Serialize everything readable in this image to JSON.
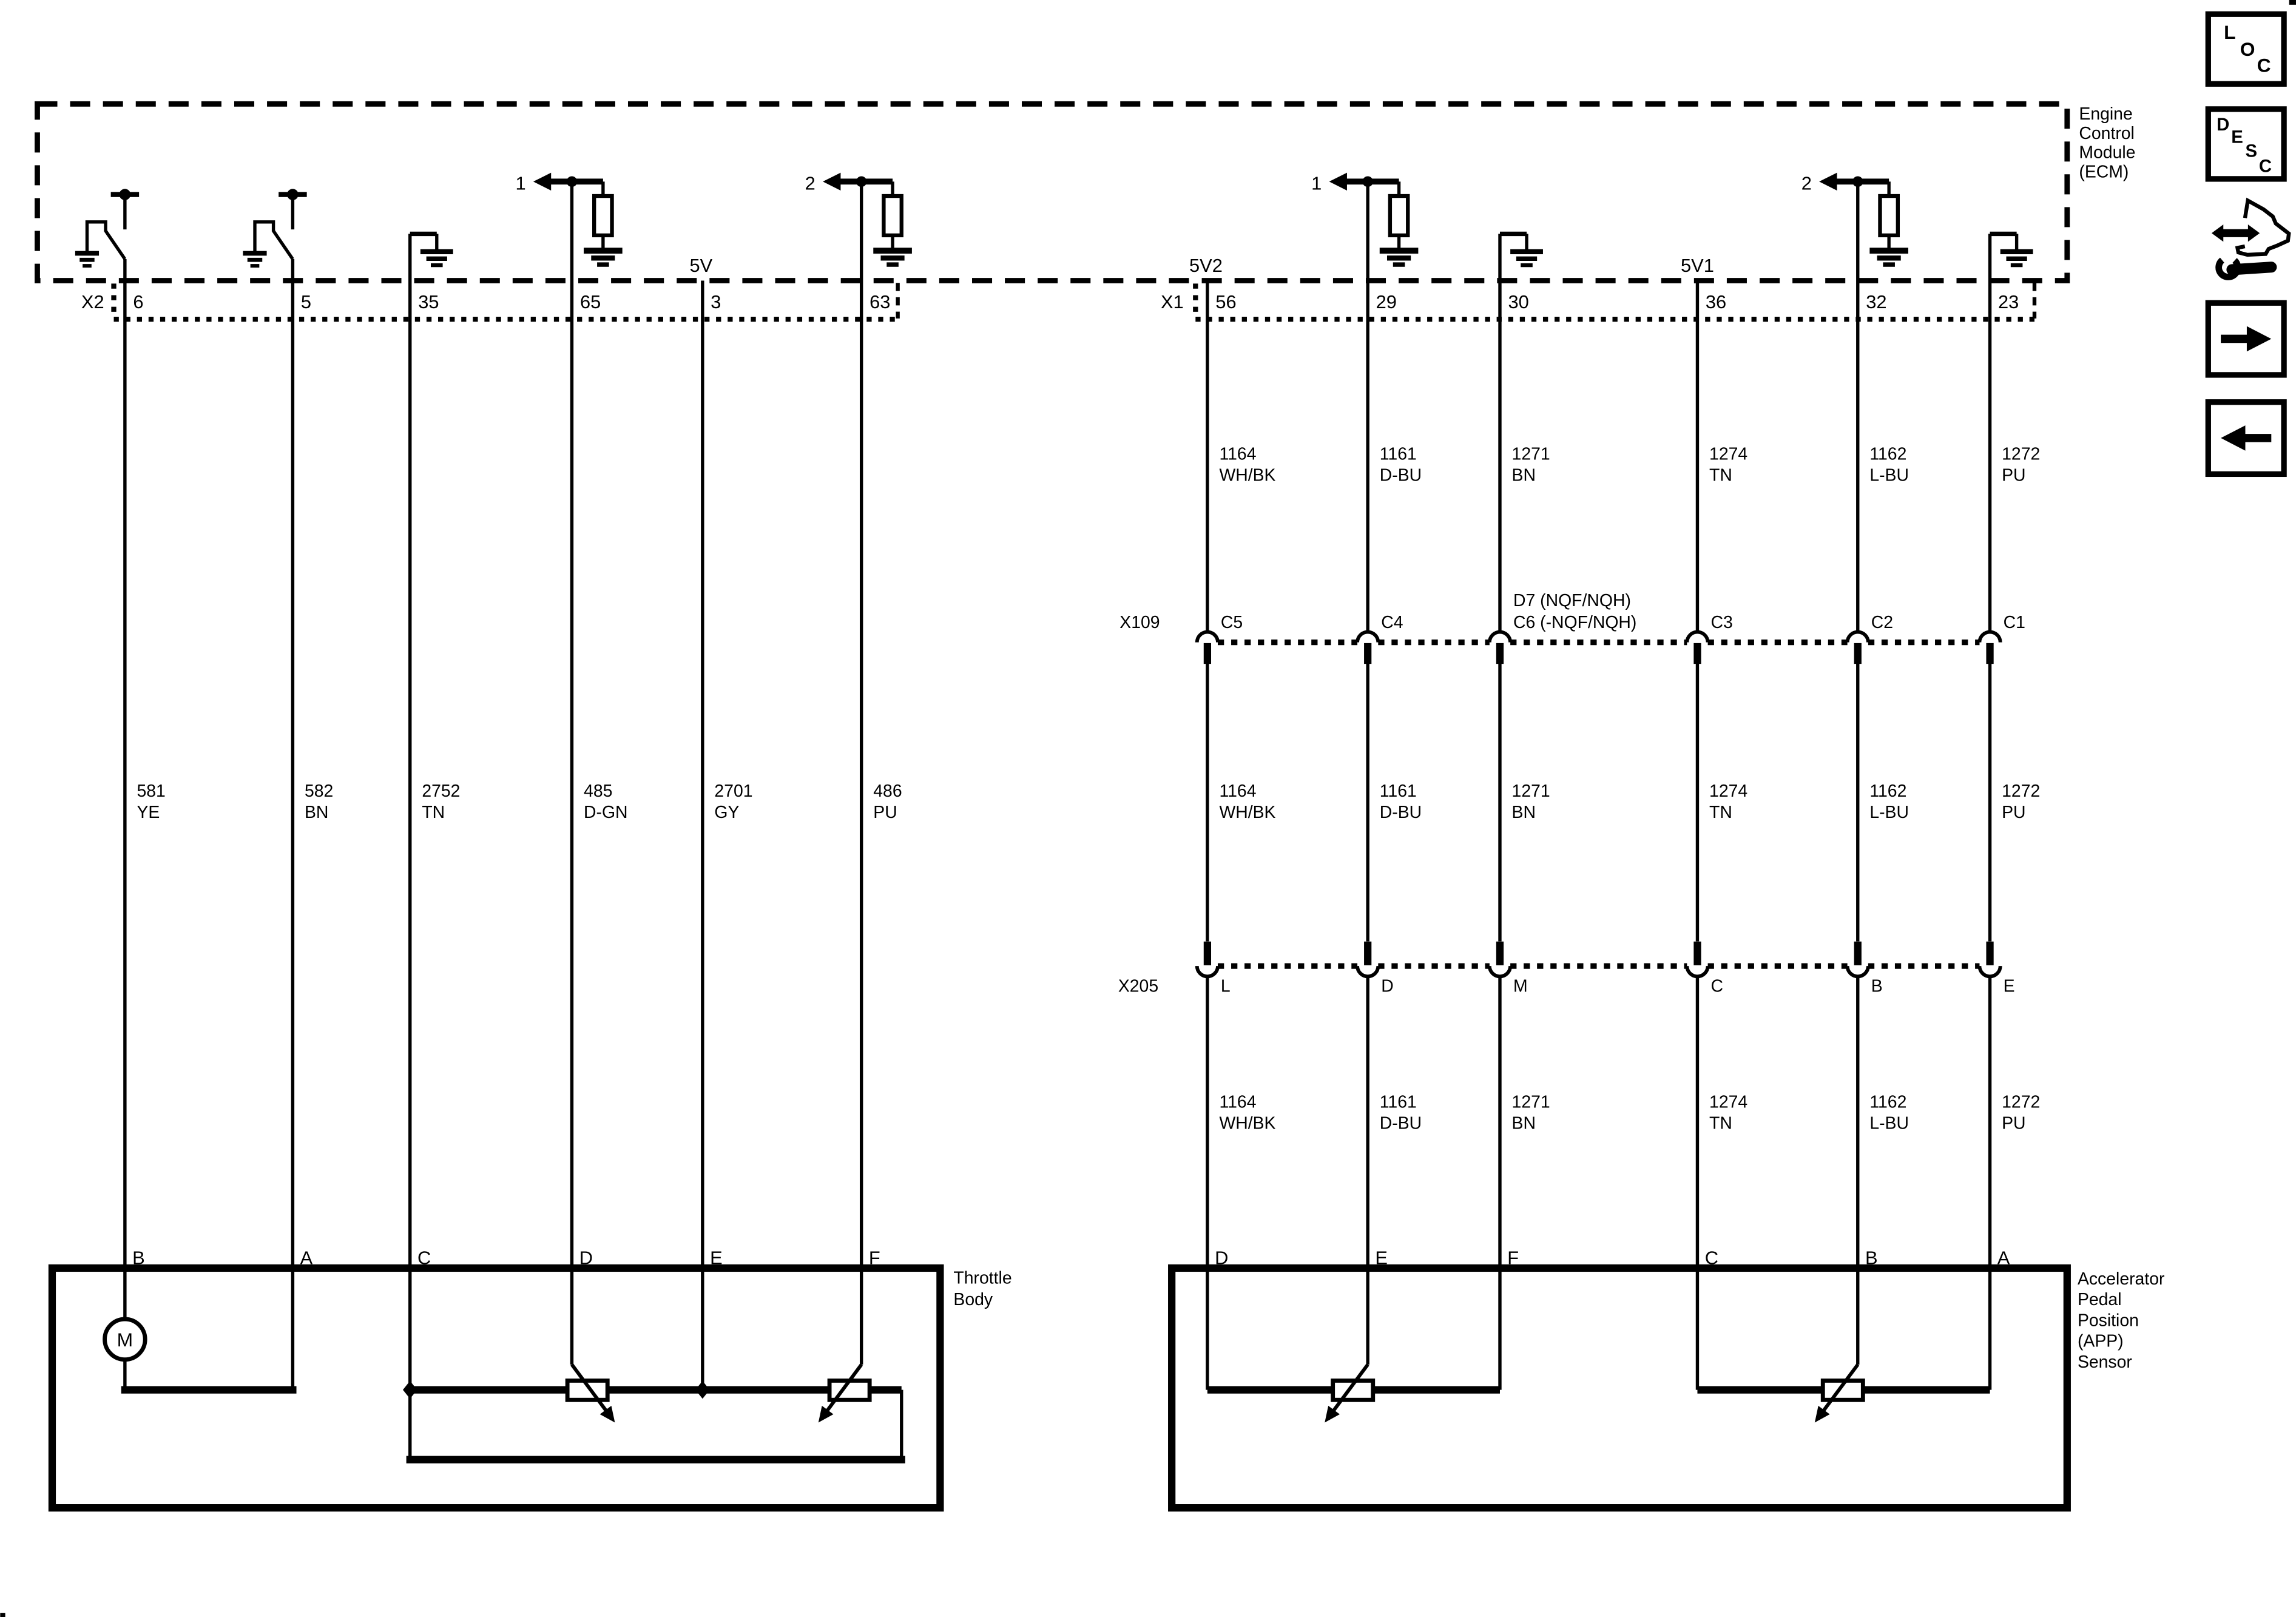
{
  "colors": {
    "ink": "#000000",
    "paper": "#ffffff"
  },
  "ecm": {
    "name_lines": [
      "Engine",
      "Control",
      "Module",
      "(ECM)"
    ],
    "supply_5v": "5V",
    "supply_5v2": "5V2",
    "supply_5v1": "5V1",
    "offpage_ref_1": "1",
    "offpage_ref_2": "2"
  },
  "connector_x2": {
    "name": "X2",
    "pins": [
      "6",
      "5",
      "35",
      "65",
      "3",
      "63"
    ]
  },
  "connector_x1": {
    "name": "X1",
    "pins": [
      "56",
      "29",
      "30",
      "36",
      "32",
      "23"
    ]
  },
  "connector_x109": {
    "name": "X109",
    "cavities": [
      "C5",
      "C4",
      "C3",
      "C2",
      "C1"
    ],
    "cavity3_line1": "D7 (NQF/NQH)",
    "cavity3_line2": "C6 (-NQF/NQH)"
  },
  "connector_x205": {
    "name": "X205",
    "cavities": [
      "L",
      "D",
      "M",
      "C",
      "B",
      "E"
    ]
  },
  "left_wires": [
    {
      "circuit": "581",
      "color": "YE"
    },
    {
      "circuit": "582",
      "color": "BN"
    },
    {
      "circuit": "2752",
      "color": "TN"
    },
    {
      "circuit": "485",
      "color": "D-GN"
    },
    {
      "circuit": "2701",
      "color": "GY"
    },
    {
      "circuit": "486",
      "color": "PU"
    }
  ],
  "right_wires": [
    {
      "circuit": "1164",
      "color": "WH/BK"
    },
    {
      "circuit": "1161",
      "color": "D-BU"
    },
    {
      "circuit": "1271",
      "color": "BN"
    },
    {
      "circuit": "1274",
      "color": "TN"
    },
    {
      "circuit": "1162",
      "color": "L-BU"
    },
    {
      "circuit": "1272",
      "color": "PU"
    }
  ],
  "throttle_body": {
    "name_lines": [
      "Throttle",
      "Body"
    ],
    "pins": [
      "B",
      "A",
      "C",
      "D",
      "E",
      "F"
    ],
    "motor_label": "M"
  },
  "app_sensor": {
    "name_lines": [
      "Accelerator",
      "Pedal",
      "Position",
      "(APP)",
      "Sensor"
    ],
    "pins": [
      "D",
      "E",
      "F",
      "C",
      "B",
      "A"
    ]
  },
  "sidebar": {
    "loc_letters": [
      "L",
      "O",
      "C"
    ],
    "desc_letters": [
      "D",
      "E",
      "S",
      "C"
    ]
  }
}
